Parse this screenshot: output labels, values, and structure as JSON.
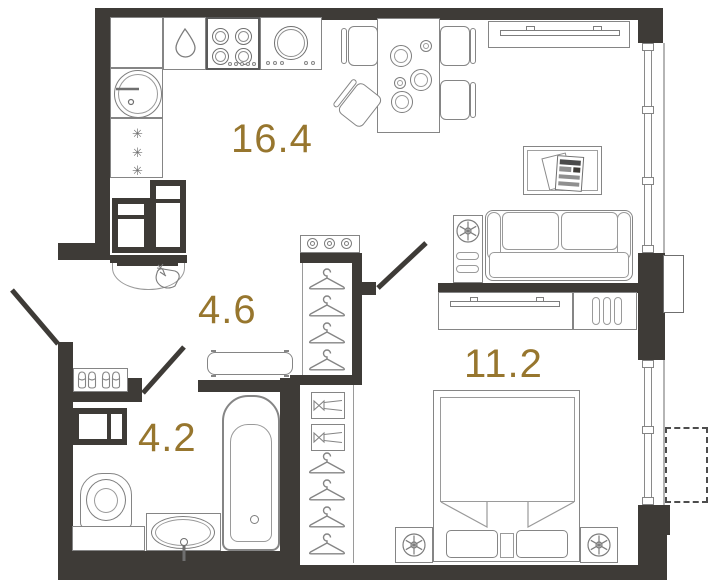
{
  "title": "Apartment floor plan",
  "rooms": [
    {
      "name": "kitchen-living-room",
      "area_label": "16.4"
    },
    {
      "name": "hallway",
      "area_label": "4.6"
    },
    {
      "name": "bathroom",
      "area_label": "4.2"
    },
    {
      "name": "bedroom",
      "area_label": "11.2"
    }
  ],
  "symbols": {
    "fridge_snowflake": "✳"
  },
  "colors": {
    "wall": "#3E3B37",
    "furniture_line": "#858585",
    "label": "#97762E",
    "background": "#FFFFFF"
  },
  "icons": [
    "drop-icon",
    "hanger-icon",
    "lamp-icon",
    "slipper-icon",
    "sparkle-bag-icon",
    "snowflake-icon"
  ]
}
